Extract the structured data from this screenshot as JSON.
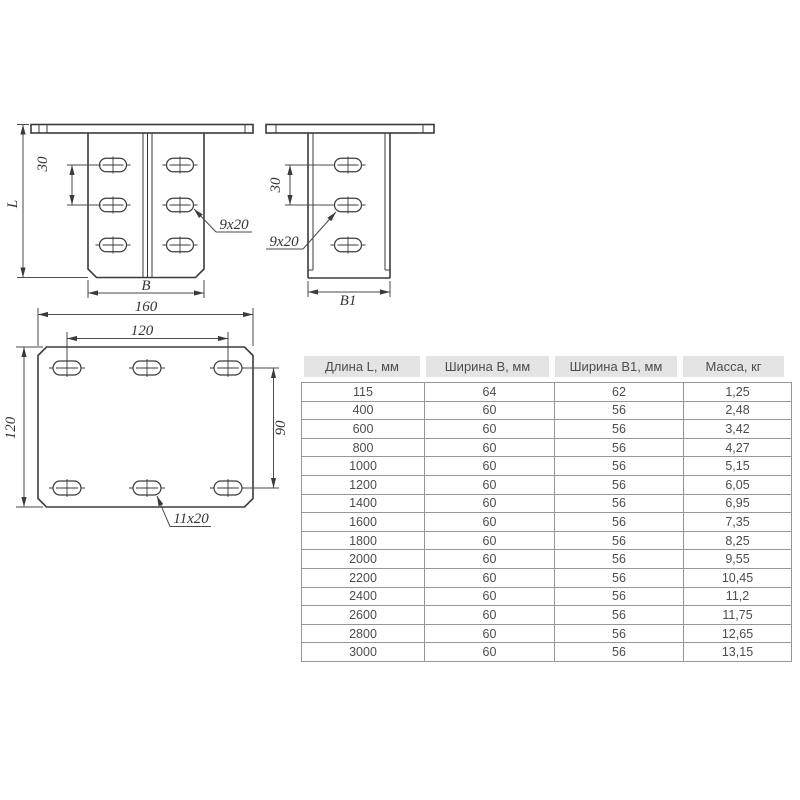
{
  "drawings": {
    "front_view": {
      "dim_l": "L",
      "dim_30": "30",
      "slot_label": "9x20",
      "dim_b": "B"
    },
    "side_view": {
      "dim_30": "30",
      "slot_label": "9x20",
      "dim_b1": "B1"
    },
    "top_view": {
      "dim_160": "160",
      "dim_120_top": "120",
      "dim_120_left": "120",
      "dim_90": "90",
      "slot_label": "11x20"
    }
  },
  "table": {
    "headers": [
      "Длина L, мм",
      "Ширина B, мм",
      "Ширина B1, мм",
      "Масса, кг"
    ],
    "rows": [
      [
        "115",
        "64",
        "62",
        "1,25"
      ],
      [
        "400",
        "60",
        "56",
        "2,48"
      ],
      [
        "600",
        "60",
        "56",
        "3,42"
      ],
      [
        "800",
        "60",
        "56",
        "4,27"
      ],
      [
        "1000",
        "60",
        "56",
        "5,15"
      ],
      [
        "1200",
        "60",
        "56",
        "6,05"
      ],
      [
        "1400",
        "60",
        "56",
        "6,95"
      ],
      [
        "1600",
        "60",
        "56",
        "7,35"
      ],
      [
        "1800",
        "60",
        "56",
        "8,25"
      ],
      [
        "2000",
        "60",
        "56",
        "9,55"
      ],
      [
        "2200",
        "60",
        "56",
        "10,45"
      ],
      [
        "2400",
        "60",
        "56",
        "11,2"
      ],
      [
        "2600",
        "60",
        "56",
        "11,75"
      ],
      [
        "2800",
        "60",
        "56",
        "12,65"
      ],
      [
        "3000",
        "60",
        "56",
        "13,15"
      ]
    ]
  },
  "colors": {
    "line": "#3b3b3b",
    "header_bg": "#e4e4e4",
    "header_text": "#4d4d4d",
    "cell_text": "#4d4d4d",
    "table_border": "#979797"
  }
}
